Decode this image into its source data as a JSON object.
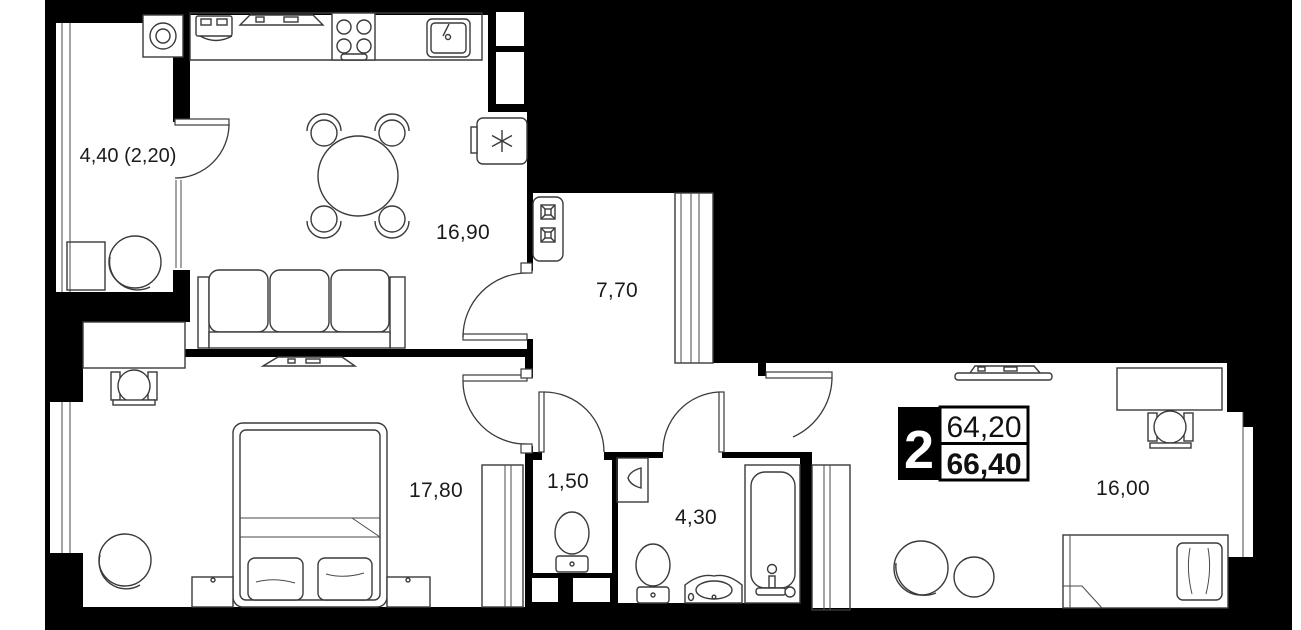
{
  "plan": {
    "type": "apartment-floor-plan",
    "colors": {
      "background": "#000000",
      "floor": "#ffffff",
      "furniture_line": "#3a3a3a",
      "text": "#1b1b1b"
    },
    "rooms": [
      {
        "id": "balcony",
        "label": "4,40 (2,20)"
      },
      {
        "id": "kitchen-living-room",
        "label": "16,90"
      },
      {
        "id": "hallway",
        "label": "7,70"
      },
      {
        "id": "bedroom-1",
        "label": "17,80"
      },
      {
        "id": "wc",
        "label": "1,50"
      },
      {
        "id": "bathroom",
        "label": "4,30"
      },
      {
        "id": "bedroom-2",
        "label": "16,00"
      }
    ],
    "info_badge": {
      "rooms_count": "2",
      "area_top": "64,20",
      "area_bottom": "66,40"
    }
  }
}
